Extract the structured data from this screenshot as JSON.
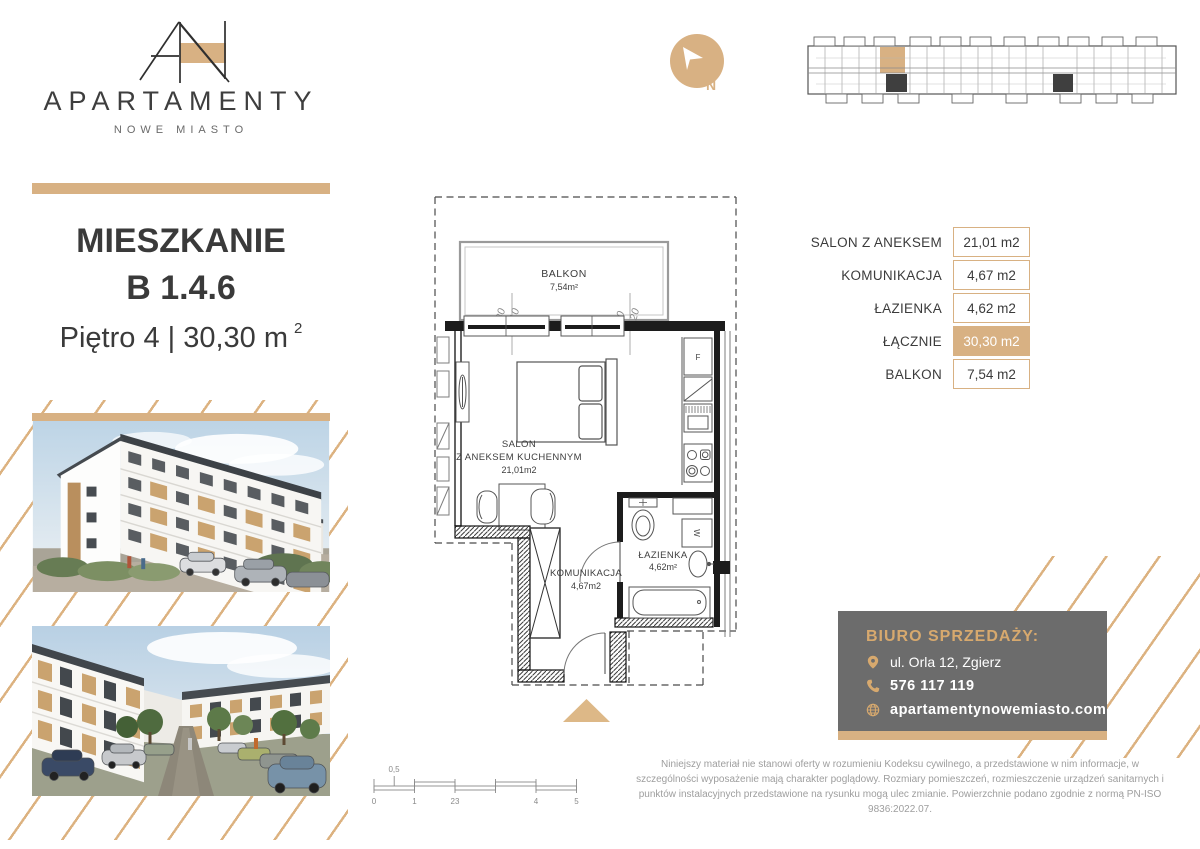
{
  "brand": {
    "name": "APARTAMENTY",
    "subtitle": "NOWE MIASTO"
  },
  "compass": {
    "label": "N"
  },
  "title": {
    "line1": "MIESZKANIE",
    "line2": "B 1.4.6",
    "line3_prefix": "Piętro 4 | 30,30 m",
    "superscript": "2"
  },
  "floorplan": {
    "balkon_label": "BALKON",
    "balkon_area": "7,54m²",
    "dim1_a": "180",
    "dim1_b": "210",
    "dim2_a": "90",
    "dim2_b": "120",
    "salon_label_1": "SALON",
    "salon_label_2": "Z ANEKSEM KUCHENNYM",
    "salon_area": "21,01m2",
    "lazienka_label": "ŁAZIENKA",
    "lazienka_area": "4,62m²",
    "komunikacja_label": "KOMUNIKACJA",
    "komunikacja_area": "4,67m2",
    "fridge_label": "F",
    "washer_label": "W"
  },
  "area_table": {
    "rows": [
      {
        "label": "SALON Z ANEKSEM",
        "value": "21,01 m2"
      },
      {
        "label": "KOMUNIKACJA",
        "value": "4,67 m2"
      },
      {
        "label": "ŁAZIENKA",
        "value": "4,62 m2"
      },
      {
        "label": "ŁĄCZNIE",
        "value": "30,30 m2"
      },
      {
        "label": "BALKON",
        "value": "7,54 m2"
      }
    ]
  },
  "contact": {
    "heading": "BIURO SPRZEDAŻY:",
    "address": "ul. Orla 12, Zgierz",
    "phone": "576 117 119",
    "website": "apartamentynowemiasto.com"
  },
  "scalebar": {
    "above_label": "0,5",
    "labels": [
      "0",
      "1",
      "23",
      "4",
      "5"
    ]
  },
  "disclaimer": "Niniejszy materiał nie stanowi oferty w rozumieniu Kodeksu cywilnego, a przedstawione w nim informacje, w szczególności wyposażenie mają charakter poglądowy. Rozmiary pomieszczeń, rozmieszczenie urządzeń sanitarnych i punktów instalacyjnych przedstawione na rysunku mogą ulec zmianie. Powierzchnie podano zgodnie z normą PN-ISO 9836:2022.07.",
  "colors": {
    "tan": "#D8B183",
    "dark_text": "#3A3A3A",
    "gray_box": "#6C6C6C",
    "gold_text": "#D7A96E"
  }
}
